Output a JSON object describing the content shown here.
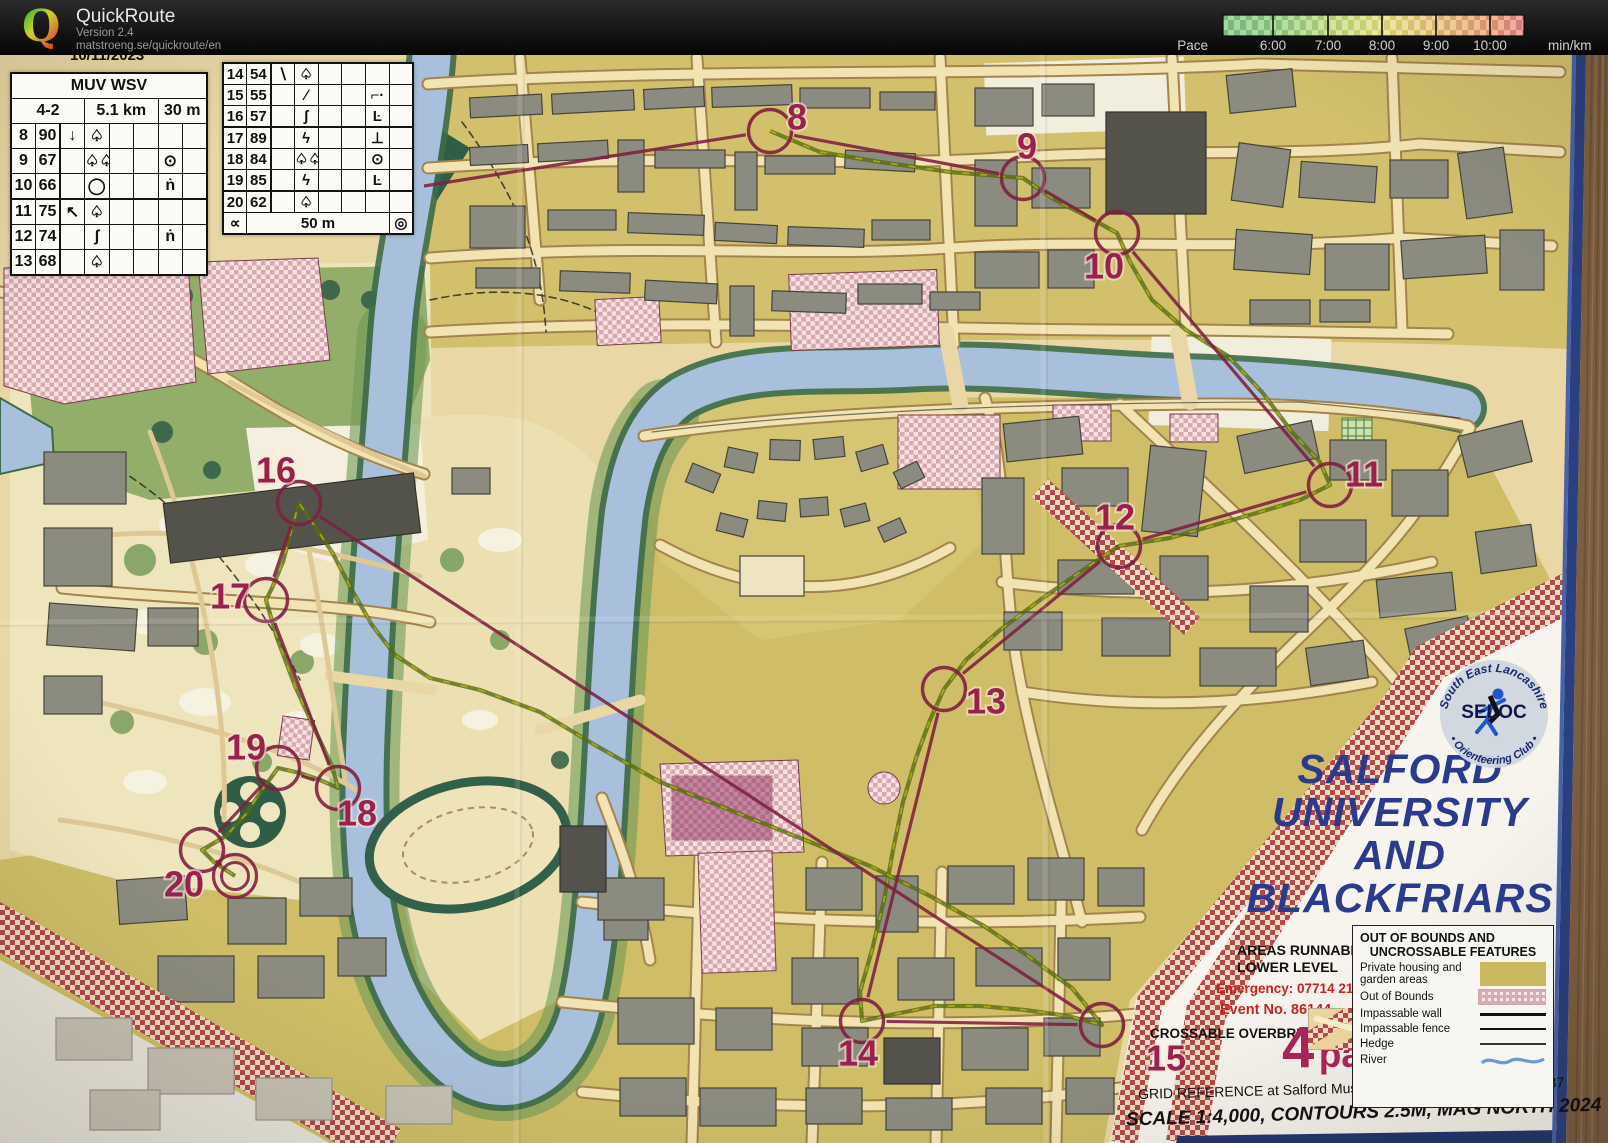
{
  "header": {
    "logo_letter": "Q",
    "app_name": "QuickRoute",
    "version": "Version 2.4",
    "url": "matstroeng.se/quickroute/en",
    "pace_label": "Pace",
    "unit_label": "min/km",
    "pace_ticks": [
      {
        "label": "6:00",
        "x": 123
      },
      {
        "label": "7:00",
        "x": 178
      },
      {
        "label": "8:00",
        "x": 232
      },
      {
        "label": "9:00",
        "x": 286
      },
      {
        "label": "10:00",
        "x": 340
      }
    ]
  },
  "control_sheet": {
    "clipped_title": "10/11/2023",
    "event_class": "MUV WSV",
    "course": "4-2",
    "length": "5.1 km",
    "climb": "30 m",
    "left_rows": [
      [
        "8",
        "90",
        "↓",
        "♤",
        "",
        "",
        "",
        ""
      ],
      [
        "9",
        "67",
        "",
        "♤♤",
        "",
        "",
        "⊙",
        ""
      ],
      [
        "10",
        "66",
        "",
        "◯",
        "",
        "",
        "ṅ",
        ""
      ],
      [
        "11",
        "75",
        "↖",
        "♤",
        "",
        "",
        "",
        ""
      ],
      [
        "12",
        "74",
        "",
        "ʃ",
        "",
        "",
        "ṅ",
        ""
      ],
      [
        "13",
        "68",
        "",
        "♤",
        "",
        "",
        "",
        ""
      ]
    ],
    "right_rows": [
      [
        "14",
        "54",
        "∖",
        "♤",
        "",
        "",
        "",
        ""
      ],
      [
        "15",
        "55",
        "",
        "∕",
        "",
        "",
        "⌐·",
        ""
      ],
      [
        "16",
        "57",
        "",
        "ʃ",
        "",
        "",
        "Ŀ",
        ""
      ],
      [
        "17",
        "89",
        "",
        "ϟ",
        "",
        "",
        "⊥",
        ""
      ],
      [
        "18",
        "84",
        "",
        "♤♤",
        "",
        "",
        "⊙",
        ""
      ],
      [
        "19",
        "85",
        "",
        "ϟ",
        "",
        "",
        "Ŀ",
        ""
      ],
      [
        "20",
        "62",
        "",
        "♤",
        "",
        "",
        "",
        ""
      ]
    ],
    "footer": {
      "left_symbol": "∝",
      "distance": "50 m",
      "right_symbol": "◎"
    }
  },
  "map": {
    "colors": {
      "course": "#7e2040",
      "label": "#9b2050",
      "route_dark": "#566b12",
      "route_light": "#c2b70e"
    },
    "entry_point": {
      "x": 424,
      "y": 186
    },
    "controls": [
      {
        "n": "8",
        "x": 770,
        "y": 131,
        "lx": 797,
        "ly": 117
      },
      {
        "n": "9",
        "x": 1023,
        "y": 178,
        "lx": 1027,
        "ly": 146
      },
      {
        "n": "10",
        "x": 1117,
        "y": 233,
        "lx": 1104,
        "ly": 266
      },
      {
        "n": "11",
        "x": 1330,
        "y": 485,
        "lx": 1364,
        "ly": 474
      },
      {
        "n": "12",
        "x": 1119,
        "y": 546,
        "lx": 1115,
        "ly": 517
      },
      {
        "n": "13",
        "x": 944,
        "y": 689,
        "lx": 986,
        "ly": 701
      },
      {
        "n": "14",
        "x": 862,
        "y": 1021,
        "lx": 858,
        "ly": 1053
      },
      {
        "n": "15",
        "x": 1102,
        "y": 1025,
        "lx": 1166,
        "ly": 1058
      },
      {
        "n": "16",
        "x": 299,
        "y": 503,
        "lx": 276,
        "ly": 470
      },
      {
        "n": "17",
        "x": 266,
        "y": 600,
        "lx": 230,
        "ly": 596
      },
      {
        "n": "18",
        "x": 338,
        "y": 788,
        "lx": 357,
        "ly": 813
      },
      {
        "n": "19",
        "x": 278,
        "y": 768,
        "lx": 246,
        "ly": 747
      },
      {
        "n": "20",
        "x": 202,
        "y": 850,
        "lx": 184,
        "ly": 884
      }
    ],
    "finish": {
      "x": 235,
      "y": 876
    },
    "route": [
      [
        770,
        131
      ],
      [
        820,
        152
      ],
      [
        880,
        162
      ],
      [
        950,
        172
      ],
      [
        1023,
        178
      ],
      [
        1055,
        200
      ],
      [
        1090,
        218
      ],
      [
        1117,
        233
      ],
      [
        1130,
        262
      ],
      [
        1152,
        300
      ],
      [
        1186,
        330
      ],
      [
        1228,
        356
      ],
      [
        1262,
        392
      ],
      [
        1292,
        432
      ],
      [
        1320,
        462
      ],
      [
        1330,
        485
      ],
      [
        1300,
        500
      ],
      [
        1260,
        512
      ],
      [
        1215,
        525
      ],
      [
        1170,
        538
      ],
      [
        1119,
        546
      ],
      [
        1080,
        572
      ],
      [
        1040,
        600
      ],
      [
        1000,
        630
      ],
      [
        966,
        660
      ],
      [
        944,
        689
      ],
      [
        930,
        720
      ],
      [
        916,
        758
      ],
      [
        903,
        802
      ],
      [
        893,
        850
      ],
      [
        884,
        900
      ],
      [
        872,
        950
      ],
      [
        860,
        992
      ],
      [
        862,
        1021
      ],
      [
        895,
        1014
      ],
      [
        935,
        1006
      ],
      [
        980,
        1006
      ],
      [
        1025,
        1010
      ],
      [
        1068,
        1016
      ],
      [
        1102,
        1025
      ],
      [
        1072,
        988
      ],
      [
        1028,
        956
      ],
      [
        984,
        926
      ],
      [
        930,
        896
      ],
      [
        870,
        866
      ],
      [
        800,
        838
      ],
      [
        730,
        810
      ],
      [
        660,
        782
      ],
      [
        595,
        745
      ],
      [
        540,
        712
      ],
      [
        480,
        690
      ],
      [
        430,
        678
      ],
      [
        395,
        655
      ],
      [
        372,
        625
      ],
      [
        352,
        590
      ],
      [
        332,
        552
      ],
      [
        312,
        522
      ],
      [
        299,
        503
      ],
      [
        291,
        532
      ],
      [
        283,
        562
      ],
      [
        272,
        588
      ],
      [
        266,
        600
      ],
      [
        277,
        638
      ],
      [
        295,
        686
      ],
      [
        315,
        730
      ],
      [
        332,
        766
      ],
      [
        338,
        788
      ],
      [
        320,
        780
      ],
      [
        300,
        773
      ],
      [
        278,
        768
      ],
      [
        262,
        790
      ],
      [
        246,
        814
      ],
      [
        226,
        836
      ],
      [
        202,
        850
      ],
      [
        214,
        862
      ],
      [
        235,
        876
      ]
    ]
  },
  "title_block": {
    "title_lines": [
      "SALFORD",
      "UNIVERSITY",
      "AND",
      "BLACKFRIARS"
    ],
    "runnable_line1": "AREAS RUNNABLE AT",
    "runnable_line2": "LOWER LEVEL",
    "emergency": "Emergency: 07714 213352",
    "event_no": "Event No. 86144",
    "overbridge": "CROSSABLE OVERBRIDGE",
    "course_number": "4",
    "course_part": "part 2",
    "grid_ref": "GRID REFERENCE at Salford Museum and Art Gallery - SJ 820 987",
    "scale_line": "SCALE 1:4,000, CONTOURS 2.5M, MAG NORTH 2024",
    "legend": {
      "title_line1": "OUT OF BOUNDS AND",
      "title_line2": "UNCROSSABLE FEATURES",
      "items": [
        {
          "label": "Private housing and garden areas",
          "swatch": "olive"
        },
        {
          "label": "Out of Bounds",
          "swatch": "oob"
        },
        {
          "label": "Impassable wall",
          "swatch": "wall"
        },
        {
          "label": "Impassable fence",
          "swatch": "fence"
        },
        {
          "label": "Hedge",
          "swatch": "hedge"
        },
        {
          "label": "River",
          "swatch": "river"
        }
      ]
    },
    "seloc": {
      "arc_top": "South East Lancashire",
      "arc_bottom": "• Orienteering Club •",
      "center": "SELOC"
    }
  }
}
